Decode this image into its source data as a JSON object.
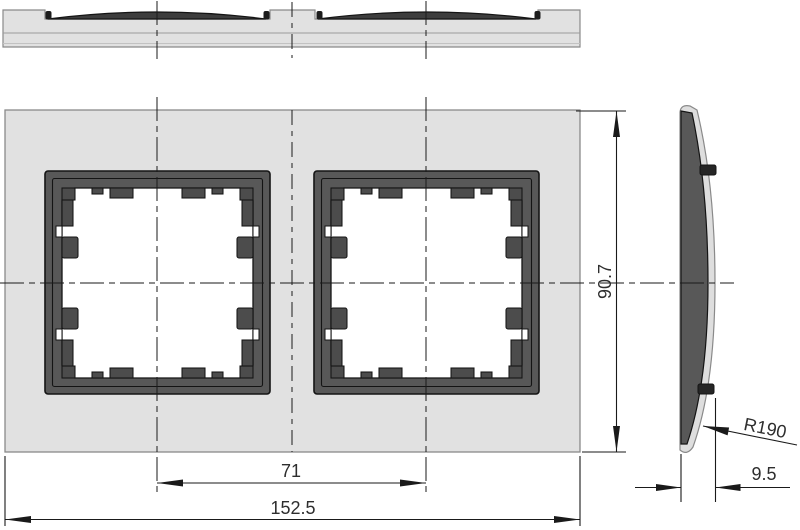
{
  "drawing": {
    "labels": {
      "overall_width": "152.5",
      "module_spacing": "71",
      "overall_height": "90.7",
      "depth": "9.5",
      "front_radius": "R190"
    },
    "colors": {
      "plate": "#e1e1e1",
      "frame_dark": "#585858",
      "clip_dark": "#4c4c4c",
      "shell_light": "#dedede",
      "edge": "#8a8a8a",
      "outline": "#141414",
      "dim_line": "#1a1a1a",
      "text": "#2e2e2e"
    }
  }
}
